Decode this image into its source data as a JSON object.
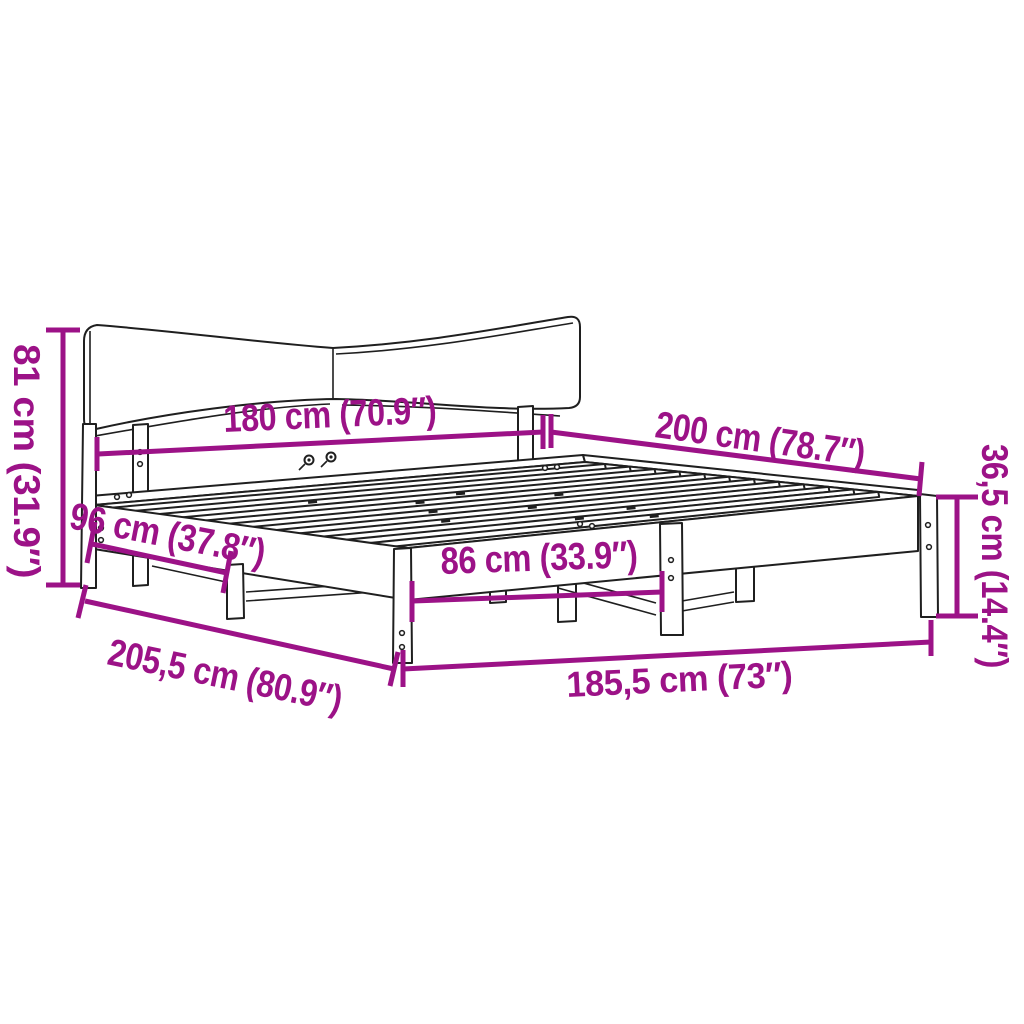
{
  "diagram_title": "Bed frame dimension diagram",
  "colors": {
    "dimension": "#9C1287",
    "line_art": "#1f1f1f",
    "background": "#ffffff"
  },
  "dims": {
    "headboard_height": {
      "label": "81 cm (31.9″)"
    },
    "headboard_width": {
      "label": "180 cm (70.9″)"
    },
    "length": {
      "label": "200 cm (78.7″)"
    },
    "frame_height": {
      "label": "36,5 cm (14.4″)"
    },
    "side_leg_gap": {
      "label": "96 cm (37.8″)"
    },
    "foot_leg_gap": {
      "label": "86 cm (33.9″)"
    },
    "total_length": {
      "label": "205,5 cm (80.9″)"
    },
    "total_width": {
      "label": "185,5 cm (73″)"
    }
  }
}
